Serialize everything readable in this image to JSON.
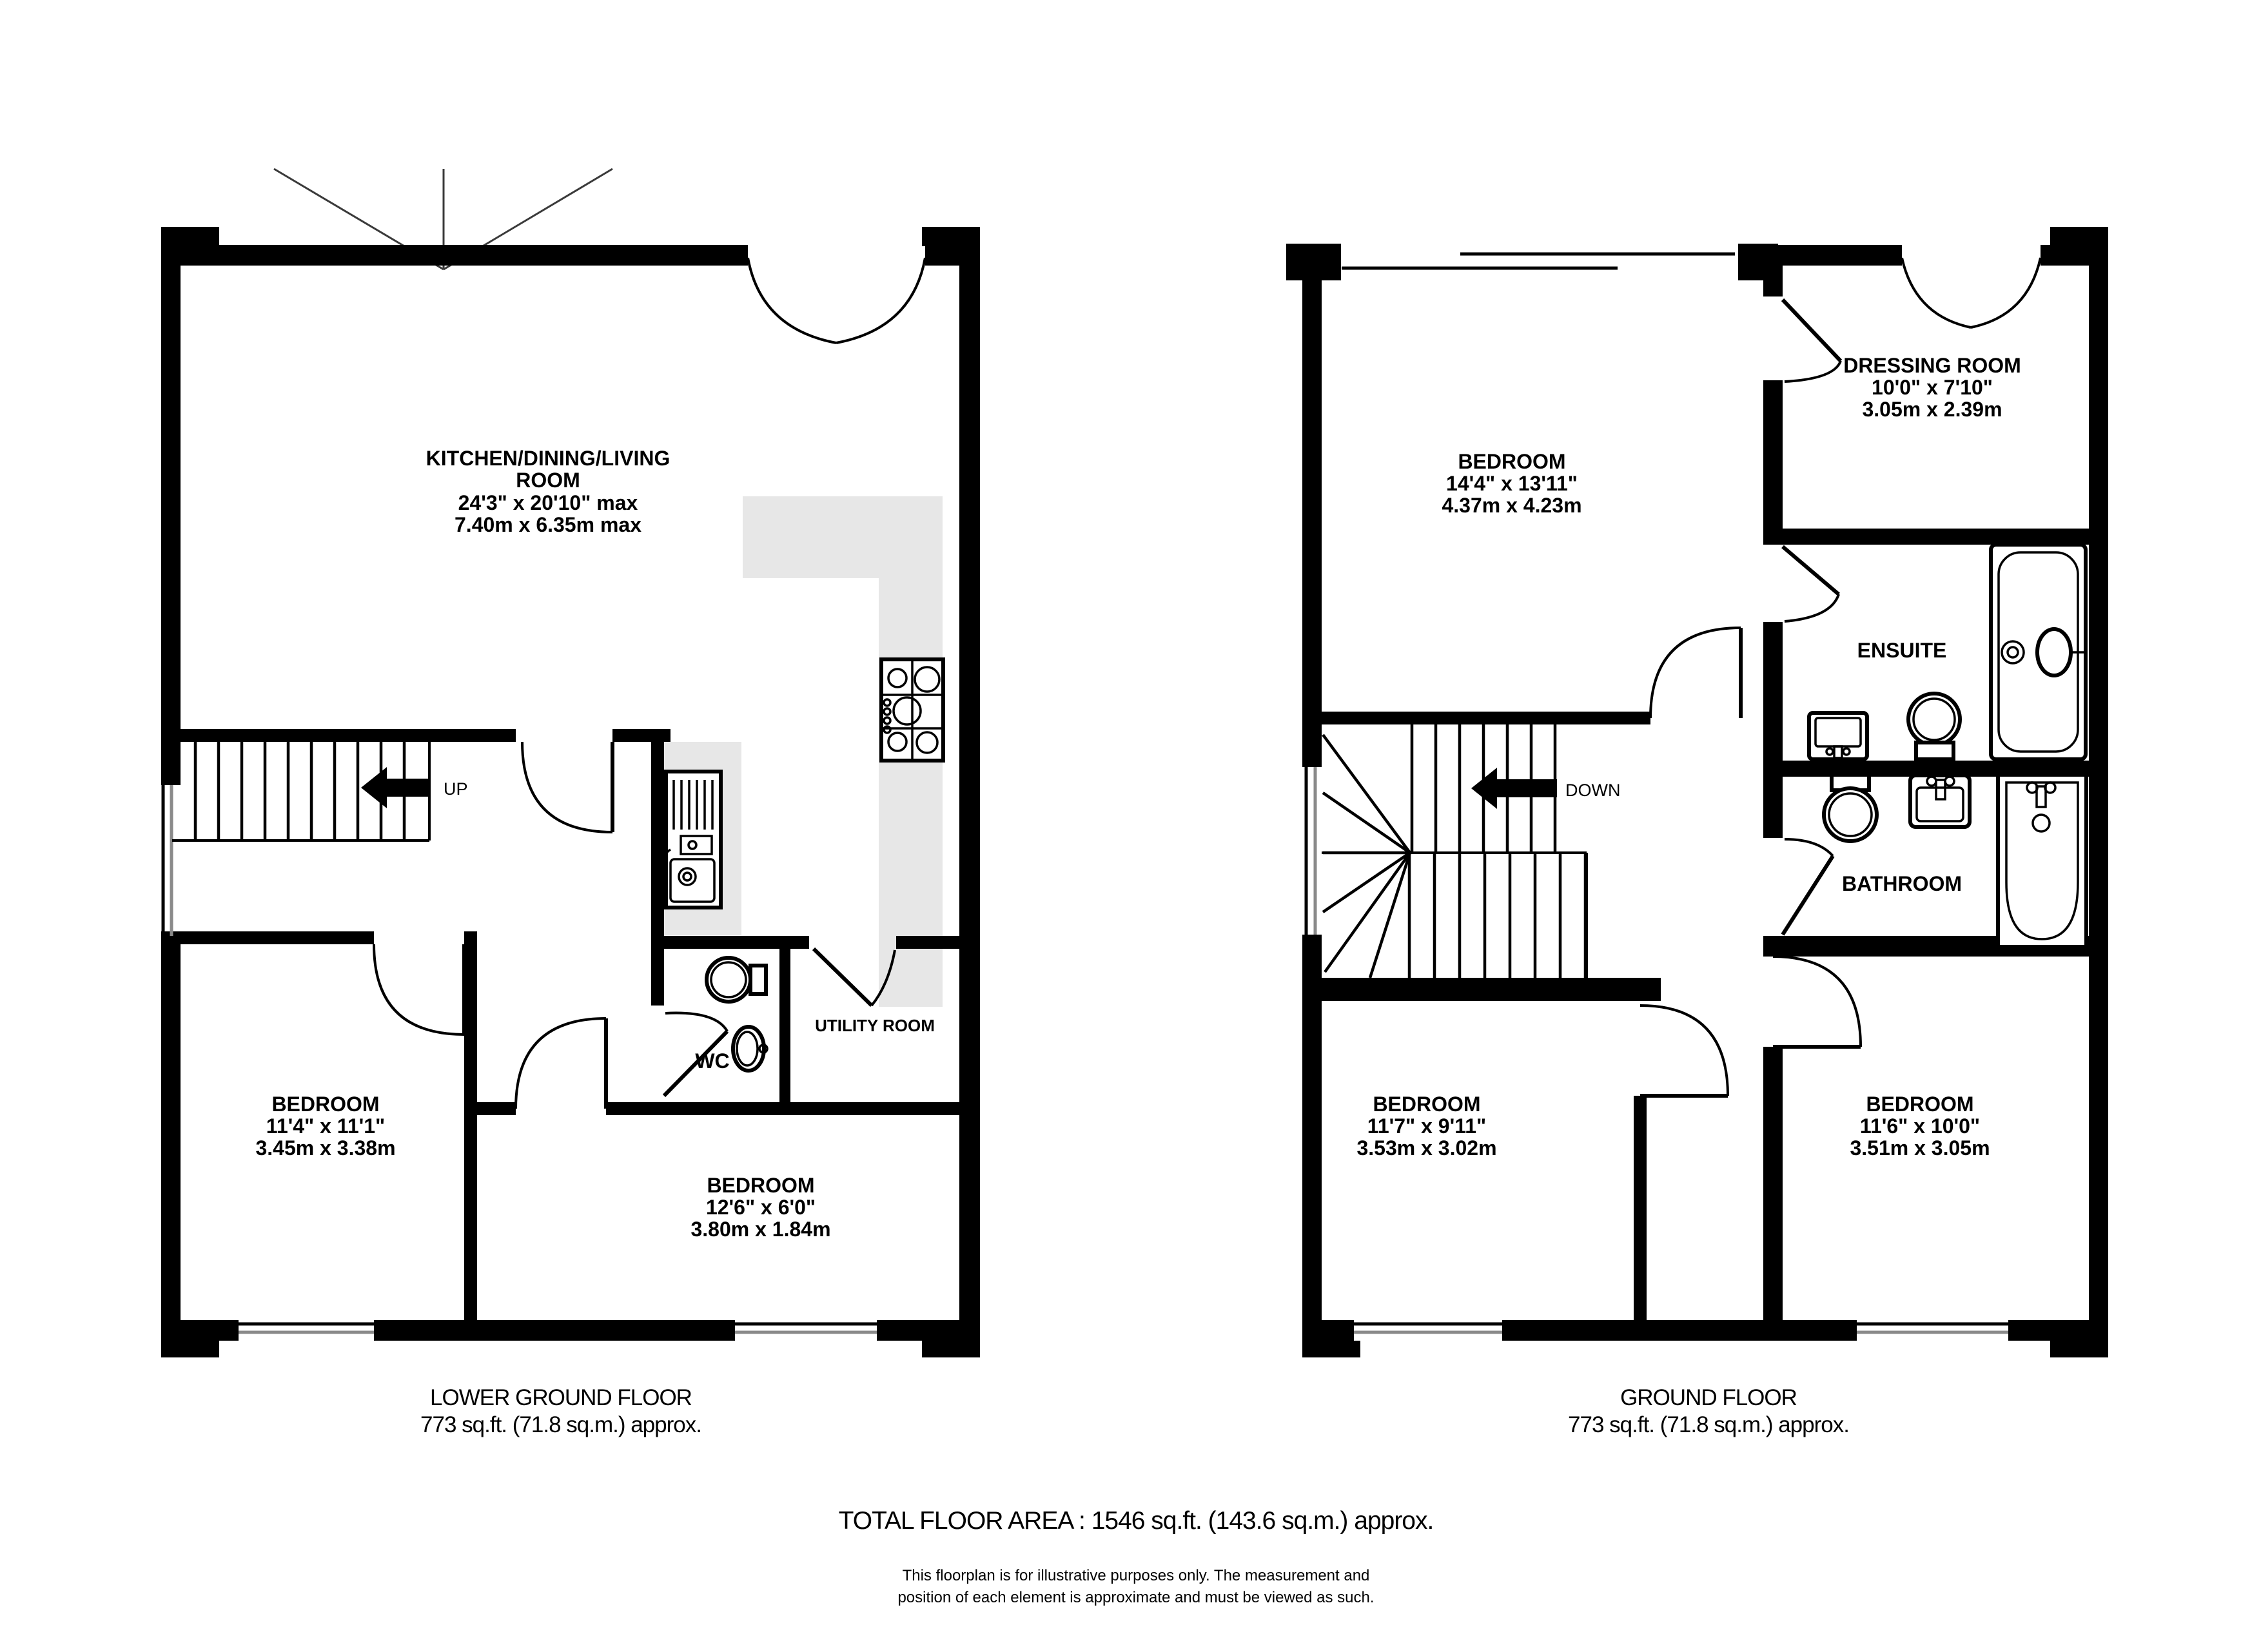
{
  "colors": {
    "wall": "#000000",
    "counter": "#e7e7e7",
    "background": "#ffffff"
  },
  "floorplan": {
    "lower": {
      "title": "LOWER GROUND FLOOR",
      "area": "773 sq.ft. (71.8 sq.m.) approx.",
      "stairs_label": "UP",
      "rooms": {
        "kitchen": {
          "line1": "KITCHEN/DINING/LIVING",
          "line2": "ROOM",
          "dims": "24'3\"  x 20'10\" max",
          "metric": "7.40m  x 6.35m max"
        },
        "bedroom1": {
          "name": "BEDROOM",
          "dims": "11'4\"  x 11'1\"",
          "metric": "3.45m  x 3.38m"
        },
        "bedroom2": {
          "name": "BEDROOM",
          "dims": "12'6\"  x 6'0\"",
          "metric": "3.80m  x 1.84m"
        },
        "wc": {
          "name": "WC"
        },
        "utility": {
          "name": "UTILITY ROOM"
        }
      }
    },
    "ground": {
      "title": "GROUND FLOOR",
      "area": "773 sq.ft. (71.8 sq.m.) approx.",
      "stairs_label": "DOWN",
      "rooms": {
        "bedroom_main": {
          "name": "BEDROOM",
          "dims": "14'4\"  x 13'11\"",
          "metric": "4.37m  x 4.23m"
        },
        "dressing": {
          "name": "DRESSING ROOM",
          "dims": "10'0\"  x 7'10\"",
          "metric": "3.05m  x 2.39m"
        },
        "ensuite": {
          "name": "ENSUITE"
        },
        "bathroom": {
          "name": "BATHROOM"
        },
        "bedroom_left": {
          "name": "BEDROOM",
          "dims": "11'7\"  x 9'11\"",
          "metric": "3.53m  x 3.02m"
        },
        "bedroom_right": {
          "name": "BEDROOM",
          "dims": "11'6\"  x 10'0\"",
          "metric": "3.51m  x 3.05m"
        }
      }
    },
    "footer": {
      "total": "TOTAL FLOOR AREA : 1546 sq.ft. (143.6 sq.m.) approx.",
      "disclaimer1": "This floorplan is for illustrative purposes only. The measurement and",
      "disclaimer2": "position of each element is approximate and must be viewed as such."
    }
  }
}
